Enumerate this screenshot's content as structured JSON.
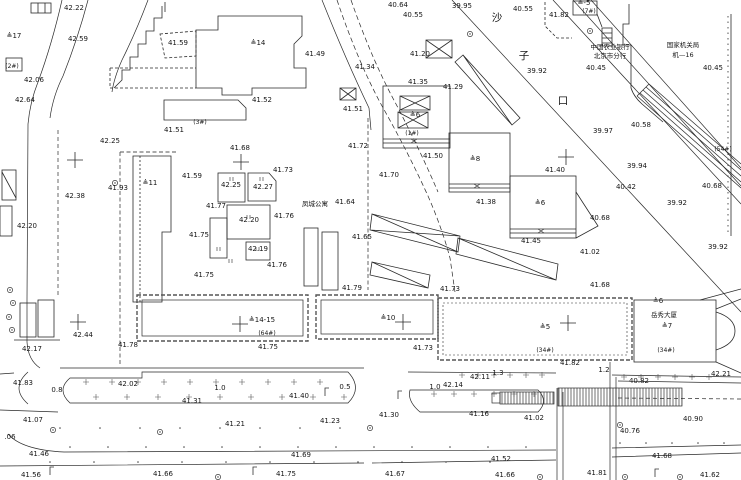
{
  "map": {
    "kind": "cad-topographic-survey-plan",
    "colors": {
      "background": "#ffffff",
      "line": "#2a2a2a",
      "label": "#161616",
      "parcel_dash": "#555555",
      "tick": "#444444"
    },
    "labels": [
      [
        74,
        10,
        "42.22",
        "e"
      ],
      [
        78,
        41,
        "42.59",
        "e"
      ],
      [
        34,
        82,
        "42.06",
        "e"
      ],
      [
        25,
        102,
        "42.64",
        "e"
      ],
      [
        178,
        45,
        "41.59",
        "e"
      ],
      [
        315,
        56,
        "41.49",
        "e"
      ],
      [
        262,
        102,
        "41.52",
        "e"
      ],
      [
        353,
        111,
        "41.51",
        "e"
      ],
      [
        174,
        132,
        "41.51",
        "e"
      ],
      [
        398,
        7,
        "40.64",
        "e"
      ],
      [
        413,
        17,
        "40.55",
        "e"
      ],
      [
        462,
        8,
        "39.95",
        "e"
      ],
      [
        523,
        11,
        "40.55",
        "e"
      ],
      [
        559,
        17,
        "41.82",
        "e"
      ],
      [
        420,
        56,
        "41.20",
        "e"
      ],
      [
        365,
        69,
        "41.34",
        "e"
      ],
      [
        418,
        84,
        "41.35",
        "e"
      ],
      [
        453,
        89,
        "41.29",
        "e"
      ],
      [
        537,
        73,
        "39.92",
        "e"
      ],
      [
        596,
        70,
        "40.45",
        "e"
      ],
      [
        713,
        70,
        "40.45",
        "e"
      ],
      [
        641,
        127,
        "40.58",
        "e"
      ],
      [
        603,
        133,
        "39.97",
        "e"
      ],
      [
        637,
        168,
        "39.94",
        "e"
      ],
      [
        626,
        189,
        "40.42",
        "e"
      ],
      [
        677,
        205,
        "39.92",
        "e"
      ],
      [
        712,
        188,
        "40.68",
        "e"
      ],
      [
        600,
        220,
        "40.68",
        "e"
      ],
      [
        718,
        249,
        "39.92",
        "e"
      ],
      [
        358,
        148,
        "41.72",
        "e"
      ],
      [
        389,
        177,
        "41.70",
        "e"
      ],
      [
        433,
        158,
        "41.50",
        "e"
      ],
      [
        555,
        172,
        "41.40",
        "e"
      ],
      [
        486,
        204,
        "41.38",
        "e"
      ],
      [
        531,
        243,
        "41.45",
        "e"
      ],
      [
        110,
        143,
        "42.25",
        "e"
      ],
      [
        75,
        198,
        "42.38",
        "e"
      ],
      [
        118,
        190,
        "41.93",
        "e"
      ],
      [
        27,
        228,
        "42.20",
        "e"
      ],
      [
        192,
        178,
        "41.59",
        "e"
      ],
      [
        240,
        150,
        "41.68",
        "e"
      ],
      [
        283,
        172,
        "41.73",
        "e"
      ],
      [
        231,
        187,
        "42.25",
        "e"
      ],
      [
        263,
        189,
        "42.27",
        "e"
      ],
      [
        216,
        208,
        "41.77",
        "e"
      ],
      [
        249,
        222,
        "42.20",
        "e"
      ],
      [
        284,
        218,
        "41.76",
        "e"
      ],
      [
        199,
        237,
        "41.75",
        "e"
      ],
      [
        258,
        251,
        "42.19",
        "e"
      ],
      [
        277,
        267,
        "41.76",
        "e"
      ],
      [
        204,
        277,
        "41.75",
        "e"
      ],
      [
        345,
        204,
        "41.64",
        "e"
      ],
      [
        362,
        239,
        "41.65",
        "e"
      ],
      [
        352,
        290,
        "41.79",
        "e"
      ],
      [
        450,
        291,
        "41.73",
        "e"
      ],
      [
        590,
        254,
        "41.02",
        "e"
      ],
      [
        600,
        287,
        "41.68",
        "e"
      ],
      [
        83,
        337,
        "42.44",
        "e"
      ],
      [
        32,
        351,
        "42.17",
        "e"
      ],
      [
        128,
        347,
        "41.78",
        "e"
      ],
      [
        23,
        385,
        "41.83",
        "e"
      ],
      [
        128,
        386,
        "42.02",
        "e"
      ],
      [
        192,
        403,
        "41.31",
        "e"
      ],
      [
        268,
        349,
        "41.75",
        "e"
      ],
      [
        423,
        350,
        "41.73",
        "e"
      ],
      [
        570,
        365,
        "41.82",
        "e"
      ],
      [
        299,
        398,
        "41.40",
        "e"
      ],
      [
        453,
        387,
        "42.14",
        "e"
      ],
      [
        480,
        379,
        "42.11",
        "e"
      ],
      [
        389,
        417,
        "41.30",
        "e"
      ],
      [
        479,
        416,
        "41.16",
        "e"
      ],
      [
        721,
        376,
        "42.21",
        "e"
      ],
      [
        639,
        383,
        "40.82",
        "e"
      ],
      [
        534,
        420,
        "41.02",
        "e"
      ],
      [
        693,
        421,
        "40.90",
        "e"
      ],
      [
        630,
        433,
        "40.76",
        "e"
      ],
      [
        33,
        422,
        "41.07",
        "e"
      ],
      [
        235,
        426,
        "41.21",
        "e"
      ],
      [
        330,
        423,
        "41.23",
        "e"
      ],
      [
        10,
        439,
        ".06",
        "e"
      ],
      [
        39,
        456,
        "41.46",
        "e"
      ],
      [
        301,
        457,
        "41.69",
        "e"
      ],
      [
        662,
        458,
        "41.68",
        "e"
      ],
      [
        501,
        461,
        "41.52",
        "e"
      ],
      [
        31,
        477,
        "41.56",
        "e"
      ],
      [
        163,
        476,
        "41.66",
        "e"
      ],
      [
        286,
        476,
        "41.75",
        "e"
      ],
      [
        395,
        476,
        "41.67",
        "e"
      ],
      [
        505,
        477,
        "41.66",
        "e"
      ],
      [
        597,
        475,
        "41.81",
        "e"
      ],
      [
        710,
        477,
        "41.62",
        "e"
      ],
      [
        57,
        392,
        "0.8",
        "d"
      ],
      [
        220,
        390,
        "1.0",
        "d"
      ],
      [
        345,
        389,
        "0.5",
        "d"
      ],
      [
        435,
        389,
        "1.0",
        "d"
      ],
      [
        498,
        375,
        "1.3",
        "d"
      ],
      [
        604,
        372,
        "1.2",
        "d"
      ],
      [
        14,
        38,
        "≜17",
        "b"
      ],
      [
        258,
        45,
        "≜14",
        "b"
      ],
      [
        150,
        185,
        "≜11",
        "b"
      ],
      [
        415,
        117,
        "≜6",
        "b"
      ],
      [
        475,
        161,
        "≜8",
        "b"
      ],
      [
        540,
        205,
        "≜6",
        "b"
      ],
      [
        262,
        322,
        "≜14-15",
        "b"
      ],
      [
        388,
        320,
        "≜10",
        "b"
      ],
      [
        545,
        329,
        "≜5",
        "b"
      ],
      [
        667,
        328,
        "≜7",
        "b"
      ],
      [
        658,
        303,
        "≜6",
        "b"
      ],
      [
        584,
        5,
        "≜-5",
        "b"
      ],
      [
        12,
        68,
        "(2#)",
        "p"
      ],
      [
        200,
        124,
        "(3#)",
        "p"
      ],
      [
        412,
        135,
        "(1#)",
        "p"
      ],
      [
        589,
        13,
        "(7#)",
        "p"
      ],
      [
        723,
        151,
        "(54#)",
        "p"
      ],
      [
        267,
        335,
        "(64#)",
        "p"
      ],
      [
        545,
        352,
        "(34#)",
        "p"
      ],
      [
        666,
        352,
        "(34#)",
        "p"
      ],
      [
        610,
        49,
        "中国农业银行",
        "n"
      ],
      [
        610,
        58,
        "北京市分行",
        "n"
      ],
      [
        683,
        47,
        "国家机关局",
        "n"
      ],
      [
        683,
        57,
        "机—16",
        "n"
      ],
      [
        315,
        206,
        "凤城公寓",
        "n"
      ],
      [
        664,
        317,
        "岳秀大厦",
        "n"
      ],
      [
        497,
        21,
        "沙",
        "c"
      ],
      [
        524,
        59,
        "子",
        "c"
      ],
      [
        563,
        104,
        "口",
        "c"
      ]
    ],
    "crosses": [
      [
        75,
        160
      ],
      [
        78,
        322
      ],
      [
        241,
        162
      ],
      [
        240,
        324
      ],
      [
        403,
        322
      ],
      [
        566,
        157
      ],
      [
        568,
        323
      ]
    ],
    "trees": [
      [
        115,
        183
      ],
      [
        10,
        290
      ],
      [
        13,
        303
      ],
      [
        9,
        317
      ],
      [
        590,
        31
      ],
      [
        470,
        34
      ],
      [
        53,
        430
      ],
      [
        160,
        432
      ],
      [
        370,
        428
      ],
      [
        620,
        425
      ],
      [
        218,
        477
      ],
      [
        540,
        477
      ],
      [
        625,
        477
      ],
      [
        680,
        477
      ],
      [
        12,
        330
      ]
    ],
    "lamps": [
      [
        325,
        391
      ],
      [
        398,
        394
      ],
      [
        253,
        470
      ],
      [
        655,
        472
      ],
      [
        50,
        470
      ]
    ],
    "plus_rows": [
      [
        382,
        86,
        340,
        26
      ],
      [
        397,
        96,
        344,
        31
      ],
      [
        394,
        434,
        536,
        20
      ],
      [
        375,
        462,
        542,
        16
      ],
      [
        377,
        624,
        714,
        17
      ]
    ],
    "dot_rows": [
      [
        447,
        70,
        540,
        38
      ],
      [
        462,
        50,
        530,
        44
      ],
      [
        443,
        620,
        730,
        26
      ],
      [
        428,
        60,
        340,
        40
      ]
    ]
  }
}
